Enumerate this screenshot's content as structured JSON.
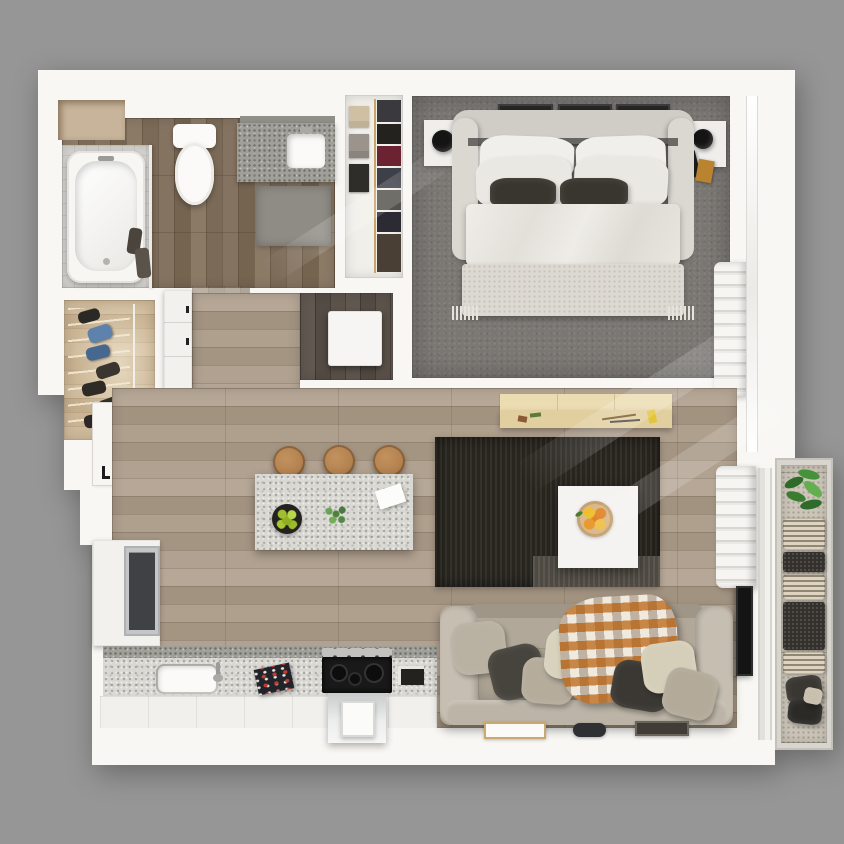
{
  "scene": {
    "type": "3d-floor-plan-render",
    "view": "top-down",
    "description": "Photorealistic overhead 3D rendering of a one-bedroom apartment floor plan on a gray background, no text labels",
    "background": "#969696"
  },
  "palette": {
    "background": "#969696",
    "plan_white": "#f8f7f4",
    "wood_light": "#ab9c8a",
    "wood_dark": "#80705d",
    "wood_deep": "#595047",
    "wood_tan": "#c8b292",
    "carpet_gray": "#7b7874",
    "rug_black": "#28251f",
    "granite_light": "#d9d8d3",
    "granite_dark": "#a09f99",
    "tile_gray": "#d7d5d0",
    "sofa_beige": "#b2a899",
    "bed_white": "#eceae5",
    "accent_dark": "#39362f",
    "stool_wood": "#b2814f",
    "lime_green": "#9fc02c",
    "lemon_yellow": "#eebf2a",
    "orange_fruit": "#e0862a",
    "plant_green": "#45923a",
    "steel": "#c6c7c8",
    "tv_black": "#141414",
    "blanket_orange": "#c1762e",
    "blanket_brown": "#5f4125"
  },
  "rooms": [
    {
      "name": "bathroom",
      "floor": "dark wood planks",
      "furniture": [
        "bathtub with tiled surround",
        "toilet",
        "granite vanity with sink",
        "wall niche",
        "bath mat",
        "hanging robes"
      ]
    },
    {
      "name": "walk-in-closet",
      "floor": "white",
      "furniture": [
        "folded clothes shelves",
        "hanging clothes rod"
      ]
    },
    {
      "name": "bedroom",
      "floor": "dark gray carpet",
      "furniture": [
        "upholstered king bed",
        "white duvet",
        "two dark accent pillows",
        "textured foot blanket",
        "left nightstand with black lamp",
        "right nightstand with black lamp",
        "three wall frames",
        "linen stack in wall closet"
      ]
    },
    {
      "name": "laundry-closet",
      "floor": "dark wood planks",
      "furniture": [
        "washer unit (white top)"
      ]
    },
    {
      "name": "shoe-closet",
      "floor": "tan wood planks",
      "furniture": [
        "shoe rack with boots and shoes"
      ]
    },
    {
      "name": "hallway",
      "floor": "light wood planks",
      "furniture": [
        "built-in white cabinets"
      ]
    },
    {
      "name": "entry",
      "floor": "light wood planks",
      "furniture": [
        "entry door with handle"
      ]
    },
    {
      "name": "kitchen",
      "floor": "light wood planks",
      "furniture": [
        "L-shaped granite counter",
        "sink with faucet",
        "gas stove and oven",
        "refrigerator in white cabinetry",
        "open cookbook",
        "granite island",
        "three wooden bar stools",
        "bowl of limes",
        "small plant",
        "paper sheet"
      ]
    },
    {
      "name": "living-dining",
      "floor": "light wood planks",
      "furniture": [
        "black area rug",
        "white coffee table with citrus plate",
        "light wood desk with stationery",
        "beige three-seat sofa with pillows",
        "plaid throw blanket",
        "wall TV",
        "floor tray",
        "remote",
        "dark floor mat",
        "linen stack"
      ]
    },
    {
      "name": "balcony",
      "floor": "woven outdoor deck",
      "furniture": [
        "potted plant",
        "striped lounger cushions",
        "dark knit cushions",
        "outdoor pillows"
      ]
    }
  ]
}
